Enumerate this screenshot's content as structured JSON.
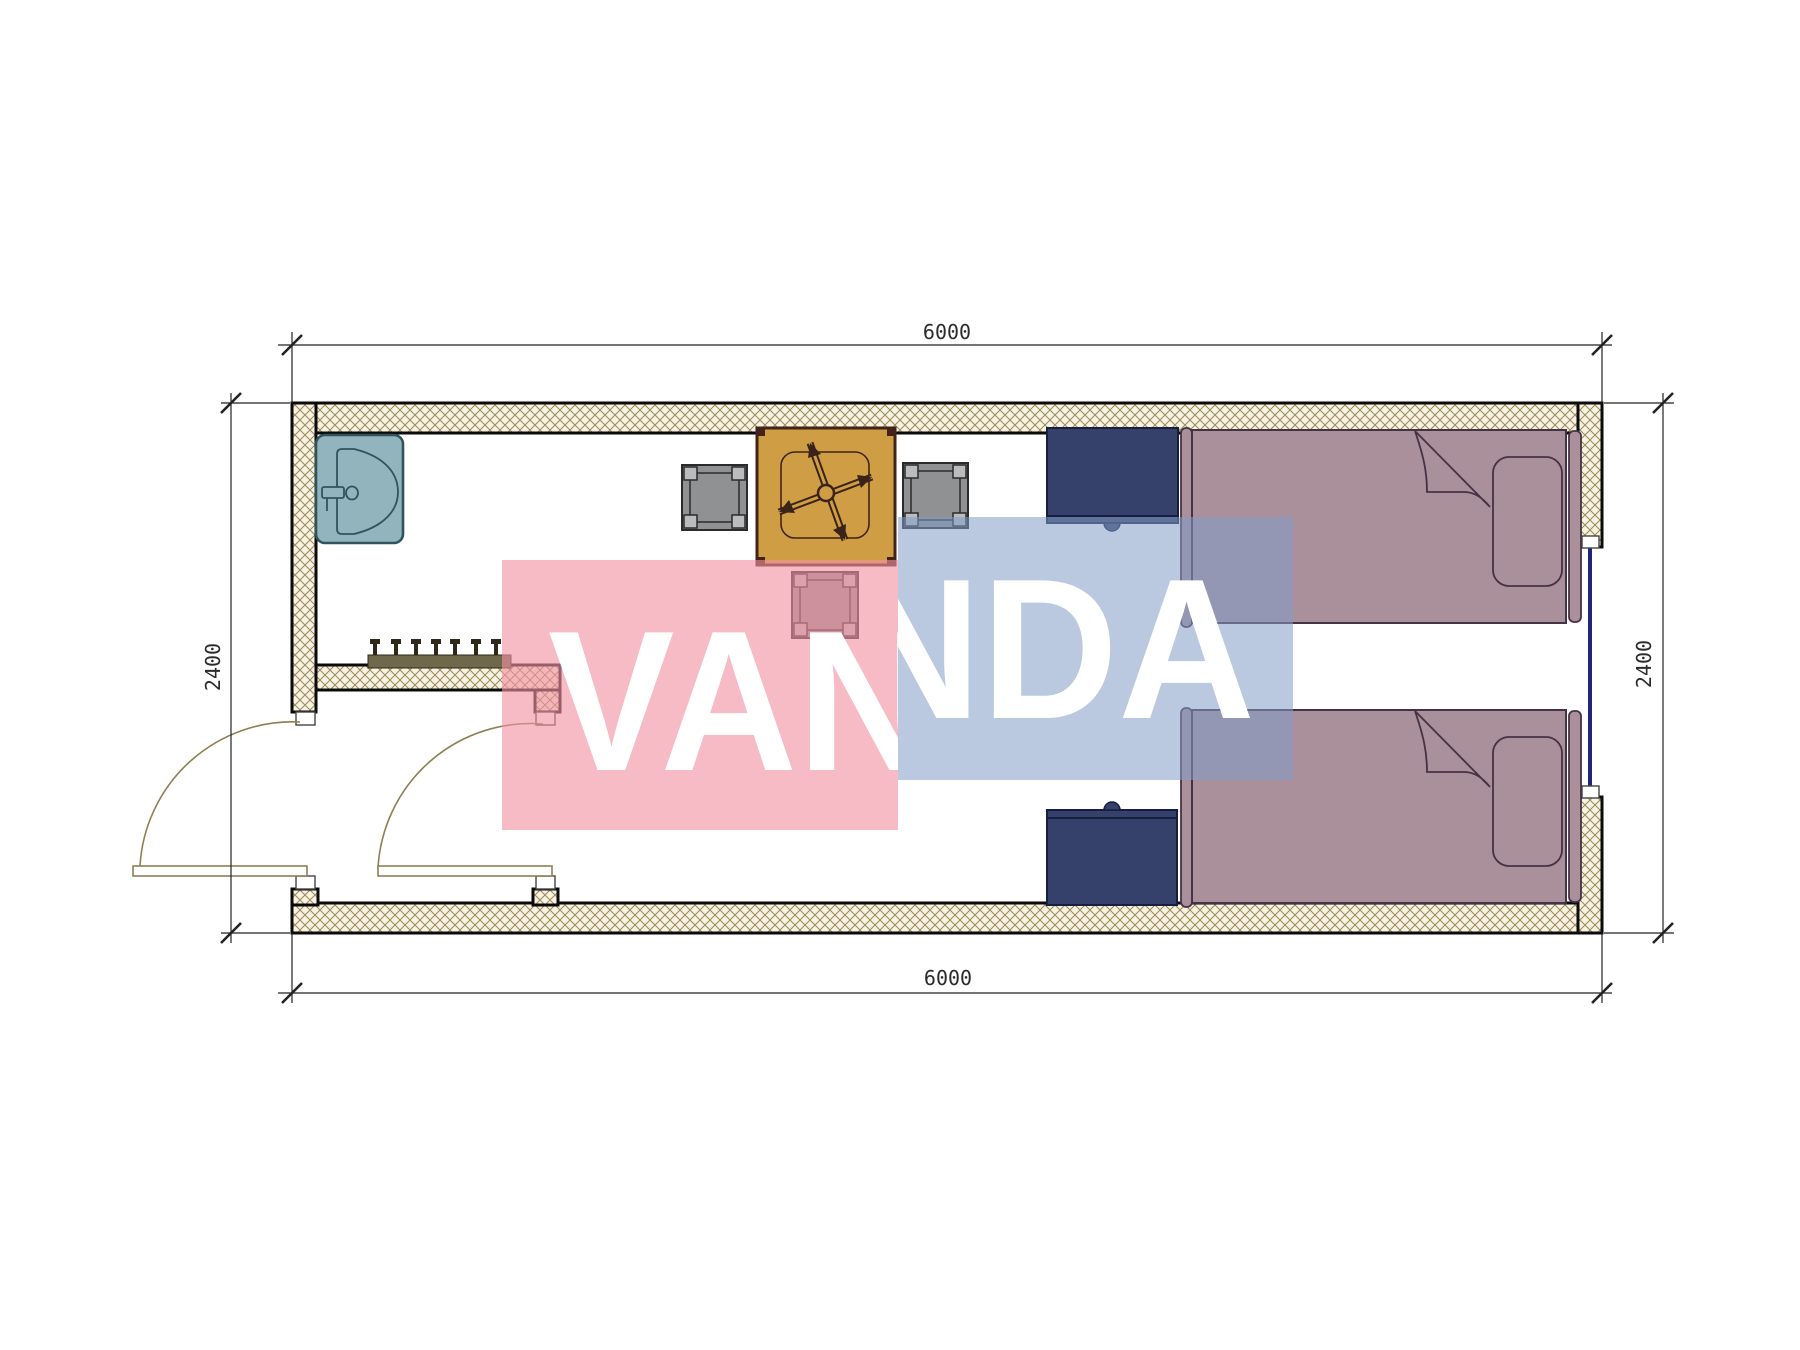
{
  "drawing": {
    "type": "floor-plan",
    "subject": "container cabin twin room"
  },
  "dimensions": {
    "top": "6000",
    "bottom": "6000",
    "left": "2400",
    "right": "2400"
  },
  "watermark": {
    "text": "VANDA",
    "pink_fill": "rgba(242,146,163,0.62)",
    "blue_fill": "rgba(130,156,199,0.55)",
    "text_color": "#ffffff"
  },
  "colors": {
    "wall_hatch_bg": "#f7f2e2",
    "wall_hatch_line": "#9b8a58",
    "wall_outline": "#0b0b0b",
    "sink": "#92b5bd",
    "sink_stroke": "#31535d",
    "table": "#cf9d44",
    "table_stroke": "#42231a",
    "chair": "#8f9193",
    "chair_post": "#babcbe",
    "chair_stroke": "#2b2b2b",
    "desk": "#35416b",
    "desk_stroke": "#151f40",
    "bed": "#a9909b",
    "bed_stroke": "#463245",
    "door_swing": "#8f7f52",
    "window_glazing": "#23237a",
    "dim_line": "#222222",
    "dim_text": "#2b2b2b",
    "coat_rack_bar": "#6f684a",
    "coat_hook": "#2e2a1a"
  },
  "components": [
    "sink",
    "dining-table",
    "ceiling-fan",
    "chair",
    "chair",
    "stool",
    "desk",
    "desk",
    "single-bed",
    "single-bed",
    "coat-rack",
    "entry-door",
    "inner-door",
    "window"
  ]
}
